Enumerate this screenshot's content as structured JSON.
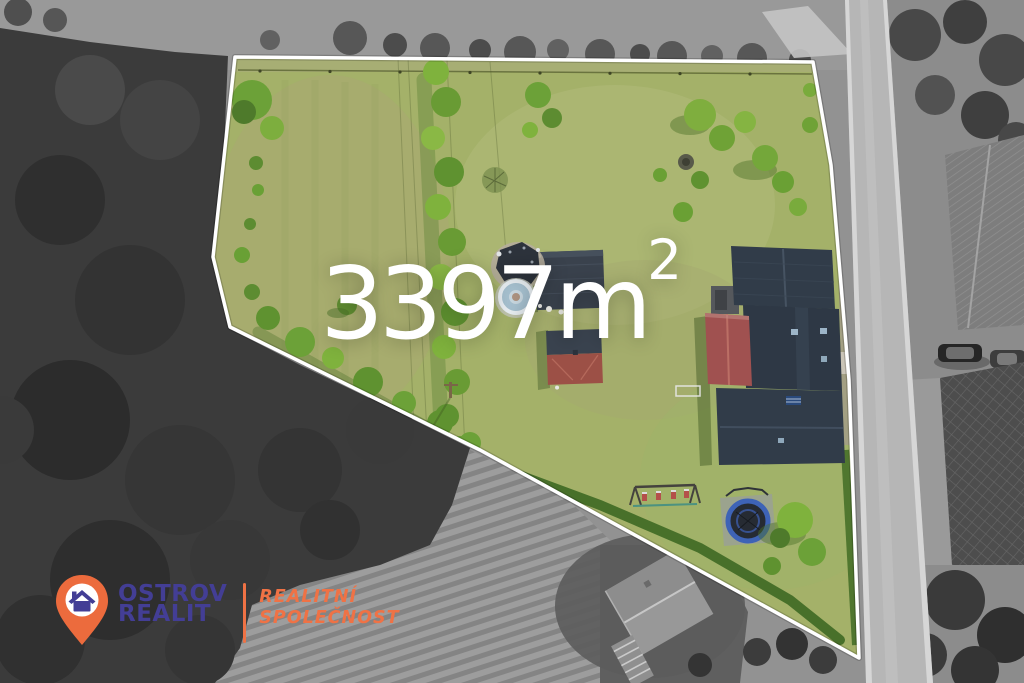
{
  "canvas": {
    "width": 1024,
    "height": 683
  },
  "overlay": {
    "area": {
      "value": "3397m",
      "superscript": "2",
      "full_text": "3397m²"
    },
    "boundary": {
      "points": "235,57 813,62 831,165 849,380 859,658 480,450 230,327 213,257"
    }
  },
  "logo": {
    "company": {
      "line1": "OSTROV",
      "line2": "REALIT"
    },
    "tagline": {
      "line1": "REALITNÍ",
      "line2": "SPOLEČNOST"
    }
  },
  "colors": {
    "brand-blue": "#433e95",
    "brand-orange": "#ef7245",
    "pin-orange": "#ec6b3d",
    "boundary-white": "#ffffff",
    "area-text": "#ffffff",
    "lawn-green": "#a4b169",
    "roof-dark": "#313c49",
    "roof-red": "#a05150",
    "trampoline-blue": "#3e63b6",
    "pool-blue": "#a6c0cf",
    "road-gray": "#b6b6b6"
  },
  "icons": {
    "pin": "location-pin-icon",
    "house": "house-icon"
  }
}
